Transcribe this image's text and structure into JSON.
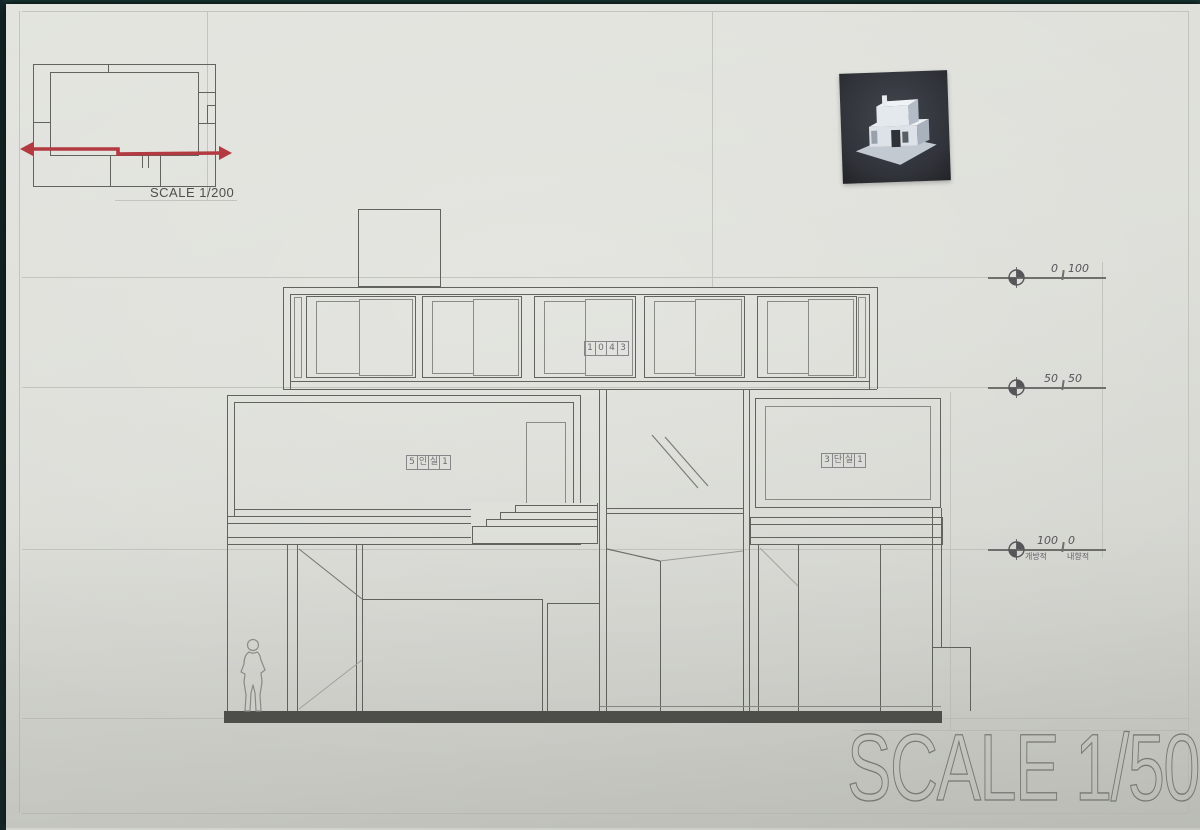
{
  "sheet": {
    "plan_inset": {
      "scale_label": "SCALE 1/200"
    },
    "title_scale_label": "SCALE 1/50",
    "room_stamps": {
      "upper": [
        "1",
        "0",
        "4",
        "3"
      ],
      "living": [
        "5",
        "인",
        "실",
        "1"
      ],
      "right": [
        "3",
        "단",
        "실",
        "1"
      ]
    },
    "level_markers": [
      {
        "left": "0",
        "right": "100",
        "left_sub": "",
        "right_sub": ""
      },
      {
        "left": "50",
        "right": "50",
        "left_sub": "",
        "right_sub": ""
      },
      {
        "left": "100",
        "right": "0",
        "left_sub": "개방적",
        "right_sub": "내향적"
      }
    ],
    "colors": {
      "paper": "#dfe0da",
      "pencil": "#62625f",
      "pencil_light": "#c3c4be",
      "section_cut_red": "#b23a40",
      "ground_slab": "#4e4e4b",
      "table_surface": "#1e403d",
      "photo_background": "#35383f",
      "model_white": "#e6eaee"
    }
  }
}
